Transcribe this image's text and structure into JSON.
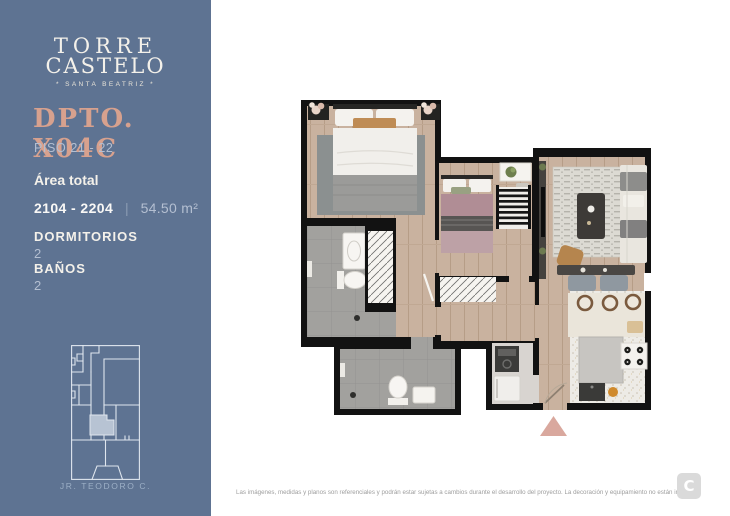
{
  "brand": {
    "name_line1": "TORRE",
    "name_line2": "CASTELO",
    "tagline": "* SANTA BEATRIZ *",
    "footer_logo_letter": "C"
  },
  "unit": {
    "title": "DPTO. X04C",
    "floors": "PISO 21 - 22",
    "area_label": "Área total",
    "unit_numbers": "2104 - 2204",
    "separator": "|",
    "area": "54.50 m²",
    "specs": [
      {
        "label": "DORMITORIOS",
        "value": "2"
      },
      {
        "label": "BAÑOS",
        "value": "2"
      }
    ]
  },
  "location": {
    "street": "JR. TEODORO C."
  },
  "footer": {
    "disclaimer": "Las imágenes, medidas y planos son referenciales y podrán estar sujetas a cambios durante el desarrollo del proyecto. La decoración y equipamiento no están incluidos."
  },
  "colors": {
    "sidebar_bg": "#5e7392",
    "accent_salmon": "#d7a18e",
    "muted_text": "#b4bfd1",
    "cream_text": "#f4f1ea",
    "map_line": "#dfe6ee",
    "map_highlight": "#b7c3d3",
    "wall": "#121212",
    "wood_floor": "#c9b29f",
    "tile_gray": "#a2a19e",
    "terrazzo": "#edebe6",
    "entrance_marker": "#d9a89e",
    "footer_logo_bg": "#dadada"
  }
}
